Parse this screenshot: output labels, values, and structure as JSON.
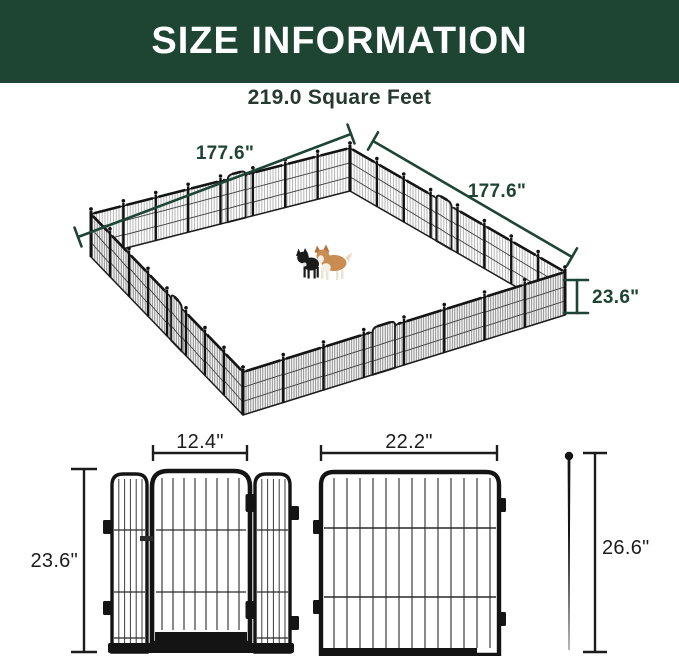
{
  "header": {
    "title": "SIZE INFORMATION"
  },
  "subtitle": {
    "area": "219.0 Square Feet"
  },
  "playpen": {
    "side_back_left": "177.6\"",
    "side_back_right": "177.6\"",
    "panel_height": "23.6\""
  },
  "door_diagram": {
    "door_width": "12.4\"",
    "panel_height": "23.6\""
  },
  "panel_diagram": {
    "panel_width": "22.2\""
  },
  "stake_diagram": {
    "stake_height": "26.6\""
  },
  "colors": {
    "accent_green": "#1e4434",
    "fence_black": "#141414",
    "corgi_tan": "#c98c52"
  }
}
